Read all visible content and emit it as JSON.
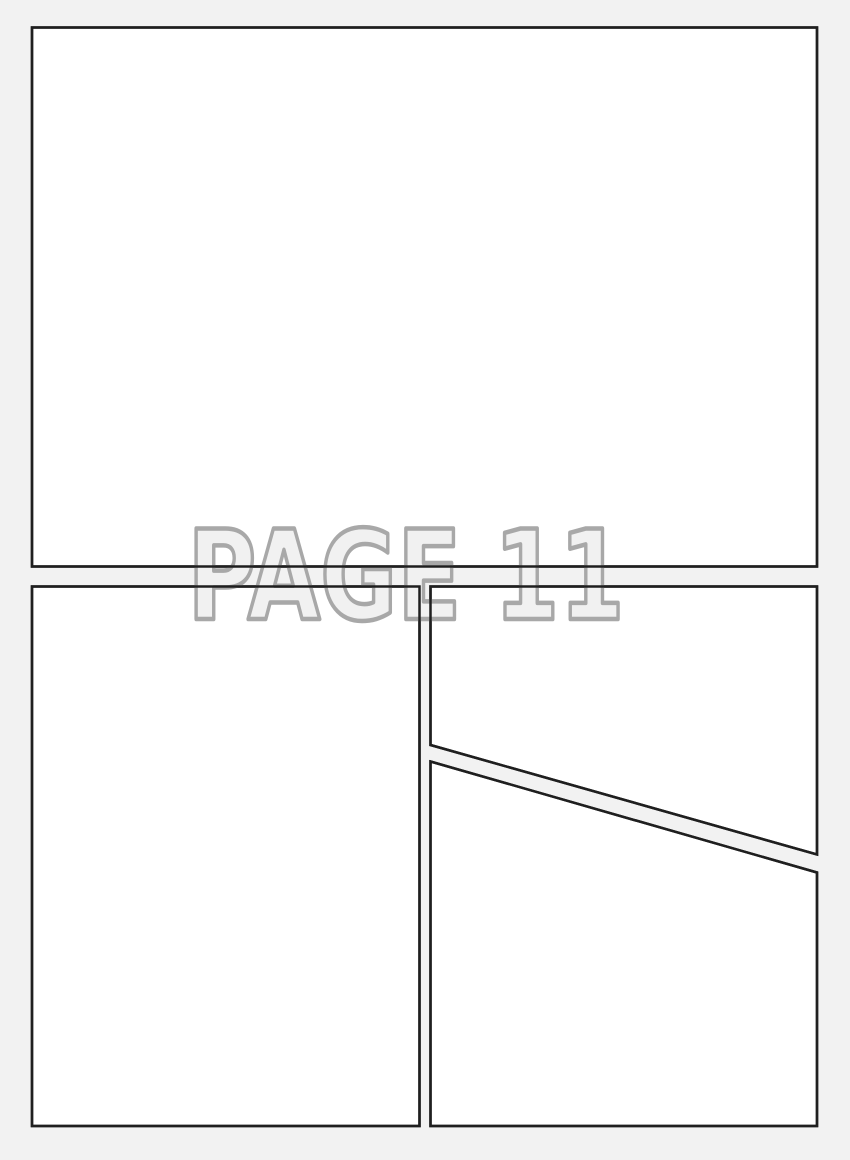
{
  "page": {
    "title_label": "PAGE 11",
    "colors": {
      "background": "#f2f2f2",
      "panel_fill": "#ffffff",
      "panel_border": "#1f1f1f",
      "title_fill": "#f1f1f1",
      "title_outline": "#a8a8a8"
    },
    "panels": [
      {
        "name": "panel-1",
        "position": "top",
        "shape": "rectangle"
      },
      {
        "name": "panel-2",
        "position": "bottom-left",
        "shape": "rectangle"
      },
      {
        "name": "panel-3",
        "position": "bottom-right-upper",
        "shape": "trapezoid"
      },
      {
        "name": "panel-4",
        "position": "bottom-right-lower",
        "shape": "trapezoid"
      }
    ]
  }
}
